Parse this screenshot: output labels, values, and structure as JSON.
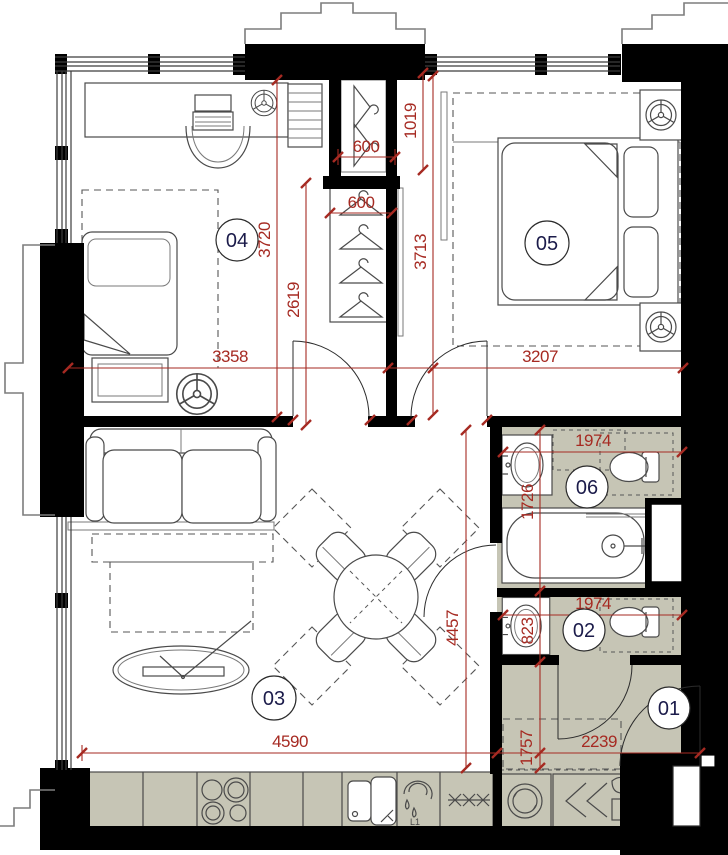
{
  "plan": {
    "title": "Apartment floor plan",
    "rooms": {
      "r01": {
        "label": "01",
        "kind": "entry hall"
      },
      "r02": {
        "label": "02",
        "kind": "wc"
      },
      "r03": {
        "label": "03",
        "kind": "living-dining room"
      },
      "r04": {
        "label": "04",
        "kind": "bedroom"
      },
      "r05": {
        "label": "05",
        "kind": "master bedroom"
      },
      "r06": {
        "label": "06",
        "kind": "bathroom"
      }
    },
    "dims": {
      "closet_top_width": "600",
      "closet_top_depth": "1019",
      "wardrobe_width": "600",
      "wardrobe_run": "2619",
      "bedroom04_depth": "3720",
      "bedroom04_width": "3358",
      "bedroom05_depth": "3713",
      "bedroom05_width": "3207",
      "bath06_width": "1974",
      "bath06_depth": "1726",
      "wc02_width": "1974",
      "wc02_depth": "823",
      "living_depth": "4457",
      "living_width": "4590",
      "entry_depth": "1757",
      "entry_width": "2239"
    },
    "labels": {
      "prep_sink": "L1"
    },
    "colors": {
      "dimension_red": "#a62a22",
      "room_fill": "#c6c5b5",
      "wall": "#000000",
      "room_number": "#1b1b4a"
    }
  }
}
